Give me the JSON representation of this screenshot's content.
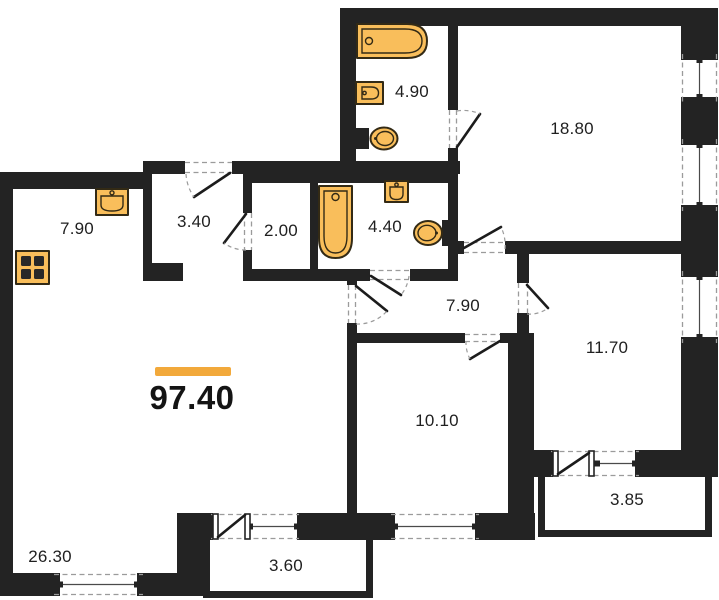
{
  "floor_plan": {
    "total_area": "97.40",
    "rooms": [
      {
        "id": "kitchen",
        "area": "7.90"
      },
      {
        "id": "entry-hall",
        "area": "3.40"
      },
      {
        "id": "storage",
        "area": "2.00"
      },
      {
        "id": "bathroom",
        "area": "4.40"
      },
      {
        "id": "ensuite-bathroom",
        "area": "4.90"
      },
      {
        "id": "bedroom-master",
        "area": "18.80"
      },
      {
        "id": "corridor",
        "area": "7.90"
      },
      {
        "id": "bedroom-2",
        "area": "11.70"
      },
      {
        "id": "bedroom-3",
        "area": "10.10"
      },
      {
        "id": "living-room",
        "area": "26.30"
      },
      {
        "id": "balcony",
        "area": "3.60"
      },
      {
        "id": "loggia",
        "area": "3.85"
      }
    ],
    "colors": {
      "wall": "#232323",
      "fixture_fill": "#F9BE5B",
      "fixture_stroke": "#332a15",
      "accent_bar": "#F2A93B",
      "dash": "#9b9b9b",
      "text": "#1f1f1f"
    }
  }
}
